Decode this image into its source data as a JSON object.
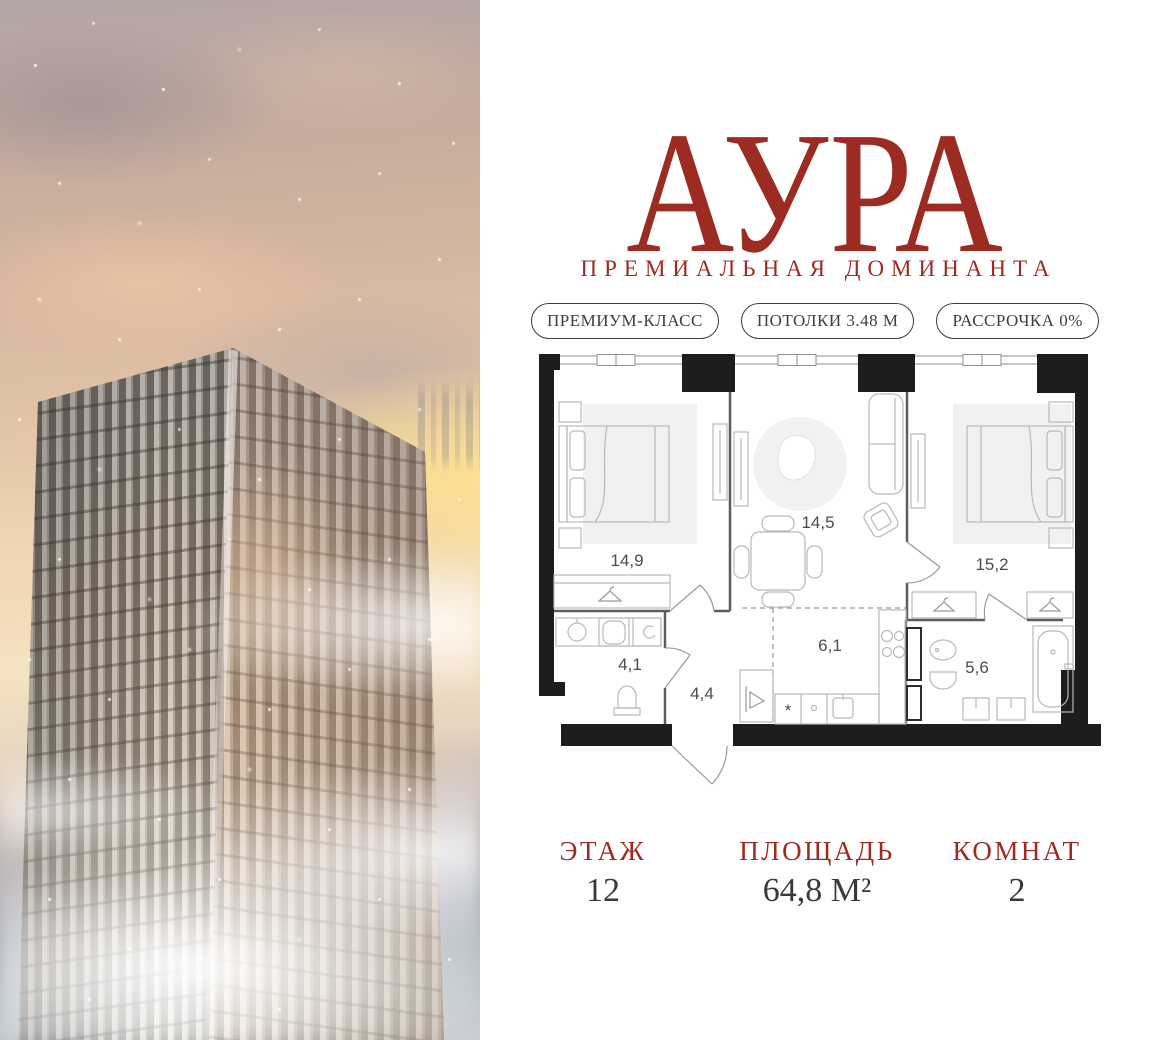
{
  "brand": {
    "logo": "АУРА",
    "tagline": "ПРЕМИАЛЬНАЯ ДОМИНАНТА",
    "accent_color": "#9C2B22",
    "text_color": "#3A3A3A"
  },
  "badges": [
    {
      "label": "ПРЕМИУМ-КЛАСС"
    },
    {
      "label": "ПОТОЛКИ 3.48 М"
    },
    {
      "label": "РАССРОЧКА 0%"
    }
  ],
  "floorplan": {
    "rooms": [
      {
        "id": "bedroom-1",
        "area": "14,9"
      },
      {
        "id": "living-room",
        "area": "14,5"
      },
      {
        "id": "bedroom-2",
        "area": "15,2"
      },
      {
        "id": "bathroom-1",
        "area": "4,1"
      },
      {
        "id": "hallway",
        "area": "4,4"
      },
      {
        "id": "kitchen",
        "area": "6,1"
      },
      {
        "id": "bathroom-2",
        "area": "5,6"
      }
    ]
  },
  "stats": [
    {
      "label": "ЭТАЖ",
      "value": "12"
    },
    {
      "label": "ПЛОЩАДЬ",
      "value": "64,8 М²"
    },
    {
      "label": "КОМНАТ",
      "value": "2"
    }
  ]
}
